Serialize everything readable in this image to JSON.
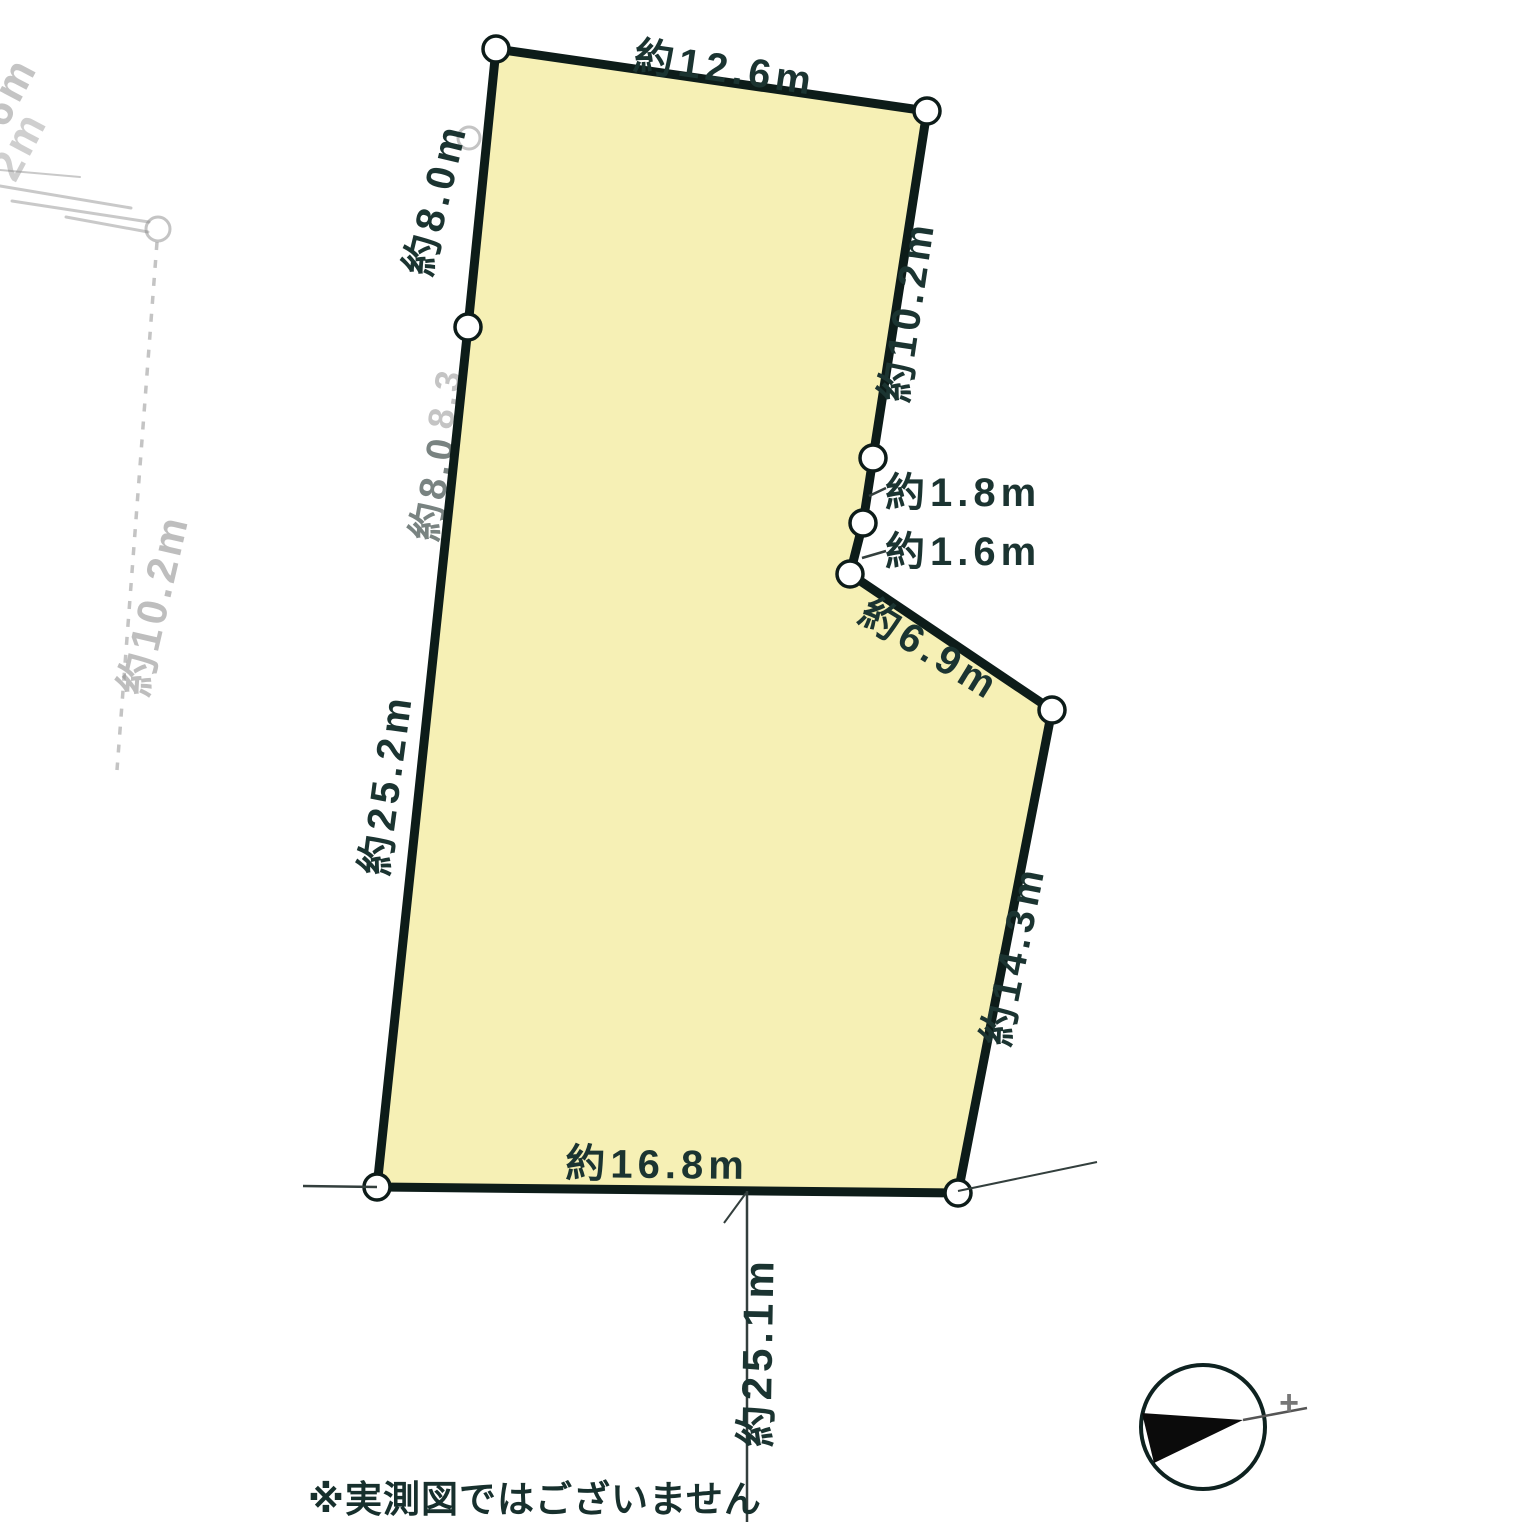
{
  "note": {
    "text": "※実測図ではございません"
  },
  "diagram": {
    "plot": {
      "fill": "#f6f0b5",
      "outline_color": "#0d1c19",
      "outline_width": 9,
      "vertices": [
        [
          496,
          49
        ],
        [
          927,
          111
        ],
        [
          873,
          458
        ],
        [
          863,
          523
        ],
        [
          850,
          574
        ],
        [
          1052,
          710
        ],
        [
          958,
          1193
        ],
        [
          377,
          1187
        ],
        [
          468,
          327
        ]
      ],
      "edge_lengths_m": [
        12.6,
        10.2,
        1.8,
        1.6,
        6.9,
        14.3,
        16.8,
        25.2,
        8.0
      ],
      "road_measure_m": 25.1
    },
    "vertex_marker": {
      "r": 13,
      "fill": "#ffffff",
      "stroke": "#0d1c19",
      "stroke_width": 3.5
    },
    "label_style": {
      "color": "#1b3431",
      "font_size": 40,
      "letter_spacing": 5,
      "font_weight": 600
    },
    "dimension_labels": [
      {
        "name": "dim-top",
        "text": "約12.6m",
        "x": 723,
        "y": 82,
        "rotate": 8.2,
        "anchor": "middle"
      },
      {
        "name": "dim-right-upper",
        "text": "約10.2m",
        "x": 921,
        "y": 313,
        "rotate": -81.5,
        "anchor": "middle"
      },
      {
        "name": "dim-step-1",
        "text": "約1.8m",
        "x": 885,
        "y": 506,
        "rotate": 0,
        "anchor": "start"
      },
      {
        "name": "dim-step-2",
        "text": "約1.6m",
        "x": 885,
        "y": 565,
        "rotate": 0,
        "anchor": "start"
      },
      {
        "name": "dim-diagonal",
        "text": "約6.9m",
        "x": 923,
        "y": 661,
        "rotate": 31.5,
        "anchor": "middle"
      },
      {
        "name": "dim-right-lower",
        "text": "約14.3m",
        "x": 1027,
        "y": 958,
        "rotate": -78.7,
        "anchor": "middle"
      },
      {
        "name": "dim-bottom",
        "text": "約16.8m",
        "x": 657,
        "y": 1178,
        "rotate": 0.6,
        "anchor": "middle"
      },
      {
        "name": "dim-left",
        "text": "約25.2m",
        "x": 400,
        "y": 786,
        "rotate": -82.4,
        "anchor": "middle"
      },
      {
        "name": "dim-left-upper",
        "text": "約8.0m",
        "x": 449,
        "y": 202,
        "rotate": -76.5,
        "anchor": "middle"
      },
      {
        "name": "dim-road-width",
        "text": "約25.1m",
        "x": 772,
        "y": 1352,
        "rotate": -89,
        "anchor": "middle",
        "font_size": 42
      }
    ],
    "aux_lines": [
      {
        "name": "road-line-left",
        "x1": 303,
        "y1": 1186,
        "x2": 377,
        "y2": 1187,
        "w": 2.5
      },
      {
        "name": "road-line-right",
        "x1": 958,
        "y1": 1191,
        "x2": 1097,
        "y2": 1162,
        "w": 2
      },
      {
        "name": "road-measure-line",
        "x1": 747,
        "y1": 1191,
        "x2": 747,
        "y2": 1522,
        "w": 2.5
      },
      {
        "name": "measure-tick",
        "x1": 746,
        "y1": 1193,
        "x2": 724,
        "y2": 1223,
        "w": 2
      },
      {
        "name": "leader-line-1-8m",
        "x1": 869,
        "y1": 496,
        "x2": 886,
        "y2": 488,
        "w": 2.5
      },
      {
        "name": "leader-line-1-6m",
        "x1": 862,
        "y1": 558,
        "x2": 886,
        "y2": 551,
        "w": 2.5
      }
    ],
    "ghost": {
      "color": "#8a8a8a",
      "texts": [
        {
          "text": "約12.6",
          "x": 628,
          "y": 125,
          "rotate": 8,
          "fs": 42,
          "op": 0.45,
          "anchor": "start"
        },
        {
          "text": "約12.6",
          "x": 640,
          "y": 158,
          "rotate": 8.5,
          "fs": 42,
          "op": 0.28,
          "anchor": "start"
        },
        {
          "text": "約10.2m",
          "x": 168,
          "y": 608,
          "rotate": -77,
          "fs": 42,
          "op": 0.55,
          "anchor": "middle"
        },
        {
          "text": "6m",
          "x": 22,
          "y": 98,
          "rotate": -62,
          "fs": 44,
          "op": 0.5,
          "anchor": "middle"
        },
        {
          "text": "2m",
          "x": 32,
          "y": 152,
          "rotate": -62,
          "fs": 44,
          "op": 0.4,
          "anchor": "middle"
        },
        {
          "text": "8.3",
          "x": 457,
          "y": 400,
          "rotate": -80,
          "fs": 36,
          "op": 0.5,
          "anchor": "middle"
        },
        {
          "text": "約8.0",
          "x": 446,
          "y": 490,
          "rotate": -80,
          "fs": 38,
          "op": 0.7,
          "anchor": "middle",
          "color": "#41504d"
        }
      ],
      "streaks": [
        [
          500,
          95,
          640,
          113,
          3
        ],
        [
          520,
          103,
          636,
          116,
          2.5
        ],
        [
          495,
          119,
          612,
          132,
          3
        ],
        [
          558,
          127,
          764,
          151,
          3.5
        ],
        [
          610,
          143,
          766,
          167,
          3.5
        ],
        [
          672,
          160,
          770,
          181,
          3.5
        ],
        [
          628,
          177,
          745,
          193,
          2.5
        ],
        [
          683,
          173,
          748,
          184,
          3
        ],
        [
          713,
          190,
          792,
          206,
          3
        ]
      ],
      "lines": [
        [
          0,
          170,
          80,
          177,
          2
        ],
        [
          0,
          186,
          131,
          208,
          3
        ],
        [
          12,
          201,
          149,
          222,
          3
        ],
        [
          66,
          217,
          148,
          232,
          3
        ]
      ],
      "dashed_lines": [
        {
          "x1": 494,
          "y1": 92,
          "x2": 461,
          "y2": 772,
          "w": 4,
          "dash": "7 10",
          "op": 0.4
        },
        {
          "x1": 157,
          "y1": 242,
          "x2": 117,
          "y2": 770,
          "w": 3.5,
          "dash": "8 10",
          "op": 0.5
        }
      ],
      "circles": [
        {
          "cx": 158,
          "cy": 229,
          "r": 12,
          "op": 0.5
        },
        {
          "cx": 469,
          "cy": 138,
          "r": 11,
          "op": 0.5
        },
        {
          "cx": 466,
          "cy": 654,
          "r": 11,
          "op": 0.45
        }
      ]
    },
    "compass": {
      "tip_mark": "+"
    }
  }
}
